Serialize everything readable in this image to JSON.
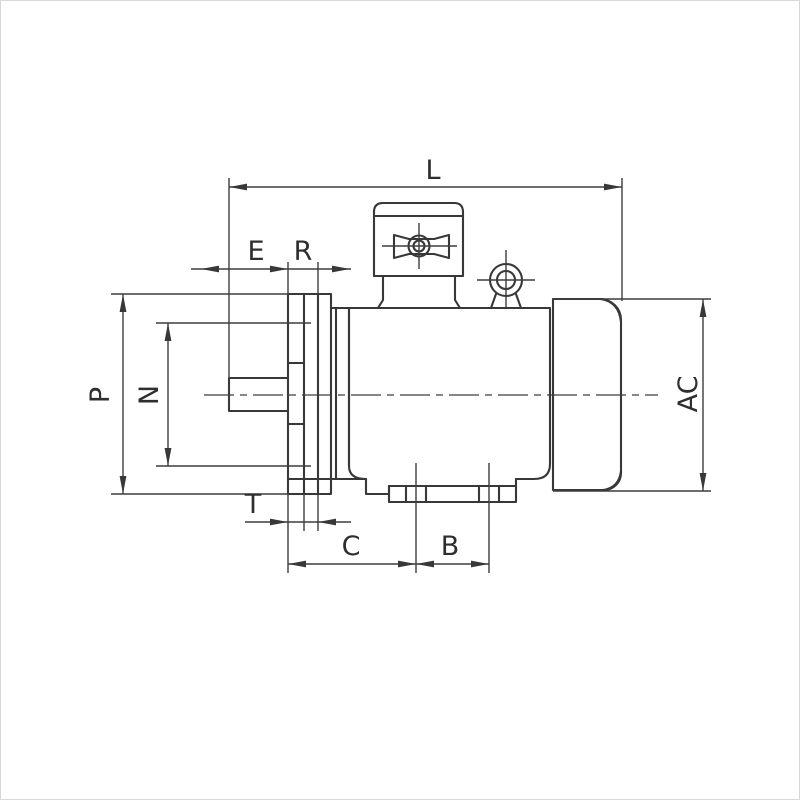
{
  "page": {
    "background": "#ffffff",
    "border_color": "#d8d8d8"
  },
  "drawing": {
    "kind": "engineering-outline-drawing",
    "subject": "flange-mounted electric motor, side view",
    "line_color": "#383838",
    "dimension_labels": {
      "L": "L",
      "E": "E",
      "R": "R",
      "P": "P",
      "N": "N",
      "T": "T",
      "C": "C",
      "B": "B",
      "AC": "AC"
    }
  }
}
